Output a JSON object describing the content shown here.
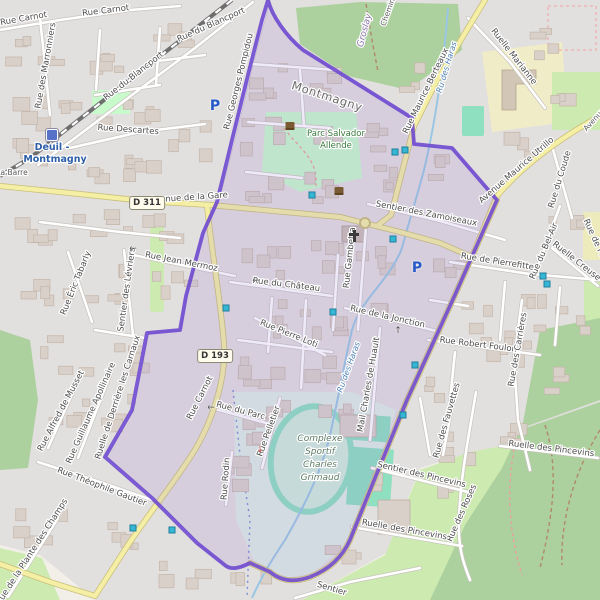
{
  "map": {
    "type": "openstreetmap-extract",
    "highlighted_boundary_commune": "Deuil-la-Barre / Montmagny area",
    "road_badges": [
      {
        "text": "D 311",
        "x": 147,
        "y": 203
      },
      {
        "text": "D 193",
        "x": 215,
        "y": 356
      }
    ],
    "labels": [
      {
        "t": "Rue Carnot",
        "x": 24,
        "y": 21,
        "r": -10,
        "c": "st"
      },
      {
        "t": "Rue Carnot",
        "x": 106,
        "y": 13,
        "r": -7,
        "c": "st"
      },
      {
        "t": "Rue du Blancport",
        "x": 212,
        "y": 27,
        "r": -24,
        "c": "st"
      },
      {
        "t": "Rue du Blancport",
        "x": 135,
        "y": 78,
        "r": -38,
        "c": "st"
      },
      {
        "t": "Rue des Marronniers",
        "x": 48,
        "y": 66,
        "r": -80,
        "c": "st"
      },
      {
        "t": "Rue Descartes",
        "x": 128,
        "y": 132,
        "r": 4,
        "c": "st"
      },
      {
        "t": "Rue Georges Pompidou",
        "x": 241,
        "y": 82,
        "r": -76,
        "c": "st"
      },
      {
        "t": "Ruelle Marianne",
        "x": 512,
        "y": 58,
        "r": 52,
        "c": "st"
      },
      {
        "t": "Rue Maurice Berteaux",
        "x": 428,
        "y": 92,
        "r": -64,
        "c": "st"
      },
      {
        "t": "Avenue Maurice Utrillo",
        "x": 518,
        "y": 172,
        "r": -41,
        "c": "st"
      },
      {
        "t": "Rue du Coude",
        "x": 562,
        "y": 180,
        "r": -73,
        "c": "st"
      },
      {
        "t": "Rue du Bel-Air",
        "x": 546,
        "y": 252,
        "r": -67,
        "c": "st"
      },
      {
        "t": "Ruelle Creuse",
        "x": 575,
        "y": 263,
        "r": 38,
        "c": "st"
      },
      {
        "t": "Rue de Pierrefitte",
        "x": 497,
        "y": 264,
        "r": 9,
        "c": "st"
      },
      {
        "t": "Rue de Pierrefitte",
        "x": 599,
        "y": 254,
        "r": 65,
        "c": "st"
      },
      {
        "t": "Rue Robert Foulon",
        "x": 478,
        "y": 347,
        "r": 7,
        "c": "st"
      },
      {
        "t": "Rue des Carrières",
        "x": 520,
        "y": 350,
        "r": -80,
        "c": "st"
      },
      {
        "t": "Sentier des Zamoiseaux",
        "x": 426,
        "y": 216,
        "r": 11,
        "c": "st"
      },
      {
        "t": "Rue Gambetta",
        "x": 352,
        "y": 258,
        "r": -84,
        "c": "st"
      },
      {
        "t": "Rue de la Jonction",
        "x": 387,
        "y": 319,
        "r": 13,
        "c": "st"
      },
      {
        "t": "Rue du Château",
        "x": 286,
        "y": 287,
        "r": 7,
        "c": "st"
      },
      {
        "t": "Rue Pierre Loti",
        "x": 288,
        "y": 336,
        "r": 22,
        "c": "st"
      },
      {
        "t": "Rue Jean Mermoz",
        "x": 181,
        "y": 264,
        "r": 11,
        "c": "st"
      },
      {
        "t": "Sentier des Lévriers",
        "x": 129,
        "y": 290,
        "r": -82,
        "c": "st"
      },
      {
        "t": "Rue Éric Tabarly",
        "x": 78,
        "y": 284,
        "r": -68,
        "c": "st"
      },
      {
        "t": "Rue Carnot",
        "x": 202,
        "y": 399,
        "r": -63,
        "c": "st"
      },
      {
        "t": "Rue du Parc",
        "x": 240,
        "y": 413,
        "r": 15,
        "c": "st"
      },
      {
        "t": "Rue Pelletier",
        "x": 271,
        "y": 432,
        "r": -70,
        "c": "st"
      },
      {
        "t": "Rue Rodin",
        "x": 228,
        "y": 479,
        "r": -86,
        "c": "st"
      },
      {
        "t": "Mail Charles de Huault",
        "x": 371,
        "y": 385,
        "r": -80,
        "c": "st"
      },
      {
        "t": "Rue des Fauvettes",
        "x": 449,
        "y": 421,
        "r": -74,
        "c": "st"
      },
      {
        "t": "Rue des Roses",
        "x": 464,
        "y": 514,
        "r": -66,
        "c": "st"
      },
      {
        "t": "Sentier des Pincevins",
        "x": 421,
        "y": 477,
        "r": 13,
        "c": "st"
      },
      {
        "t": "Ruelle des Pincevins",
        "x": 551,
        "y": 451,
        "r": 7,
        "c": "st"
      },
      {
        "t": "Ruelle des Pincevins",
        "x": 404,
        "y": 532,
        "r": 10,
        "c": "st"
      },
      {
        "t": "Rue Alfred de Musset",
        "x": 63,
        "y": 412,
        "r": -62,
        "c": "st"
      },
      {
        "t": "Rue Guillaume Apollinaire",
        "x": 93,
        "y": 414,
        "r": -66,
        "c": "st"
      },
      {
        "t": "Ruelle de Derrière les Carnaux",
        "x": 120,
        "y": 398,
        "r": -72,
        "c": "st"
      },
      {
        "t": "Rue Théophile Gautier",
        "x": 101,
        "y": 489,
        "r": 21,
        "c": "st"
      },
      {
        "t": "Rue de la Plante des Champs",
        "x": 34,
        "y": 553,
        "r": -57,
        "c": "st"
      },
      {
        "t": "Avenue de la Gare",
        "x": 189,
        "y": 200,
        "r": -4,
        "c": "st"
      },
      {
        "t": "Sentier",
        "x": 331,
        "y": 591,
        "r": 17,
        "c": "st"
      },
      {
        "t": "La Barre",
        "x": 12,
        "y": 175,
        "r": 0,
        "c": "stsm"
      },
      {
        "t": "Groslay",
        "x": 367,
        "y": 31,
        "r": -75,
        "c": "bname"
      },
      {
        "t": "Chemin",
        "x": 390,
        "y": 13,
        "r": -70,
        "c": "stsm"
      },
      {
        "t": "Avenue",
        "x": 596,
        "y": 121,
        "r": -48,
        "c": "stsm"
      },
      {
        "t": "Montmagny",
        "x": 326,
        "y": 100,
        "r": 18,
        "c": "city"
      },
      {
        "t": "Parc Salvador",
        "x": 336,
        "y": 136,
        "r": 0,
        "c": "park"
      },
      {
        "t": "Allende",
        "x": 336,
        "y": 148,
        "r": 0,
        "c": "park"
      },
      {
        "t": "Complexe",
        "x": 320,
        "y": 441,
        "r": 0,
        "c": "sport"
      },
      {
        "t": "Sportif",
        "x": 320,
        "y": 454,
        "r": 0,
        "c": "sport"
      },
      {
        "t": "Charles",
        "x": 320,
        "y": 467,
        "r": 0,
        "c": "sport"
      },
      {
        "t": "Grimaud",
        "x": 320,
        "y": 480,
        "r": 0,
        "c": "sport"
      },
      {
        "t": "Ru des Haras",
        "x": 449,
        "y": 68,
        "r": -73,
        "c": "water"
      },
      {
        "t": "Ru des Haras",
        "x": 351,
        "y": 368,
        "r": -70,
        "c": "water"
      },
      {
        "t": "Deuil -",
        "x": 52,
        "y": 150,
        "r": 0,
        "c": "station"
      },
      {
        "t": "Montmagny",
        "x": 55,
        "y": 162,
        "r": 0,
        "c": "station"
      }
    ],
    "icons": {
      "parking": [
        {
          "x": 215,
          "y": 106
        },
        {
          "x": 417,
          "y": 268
        }
      ],
      "station": {
        "x": 52,
        "y": 135,
        "name": "Deuil - Montmagny"
      },
      "church": {
        "x": 354,
        "y": 236
      },
      "town_hall": {
        "x": 339,
        "y": 191
      },
      "landmark": {
        "x": 290,
        "y": 126
      },
      "stop_markers": [
        [
          312,
          195
        ],
        [
          395,
          152
        ],
        [
          405,
          150
        ],
        [
          226,
          308
        ],
        [
          333,
          312
        ],
        [
          393,
          239
        ],
        [
          415,
          365
        ],
        [
          403,
          415
        ],
        [
          543,
          276
        ],
        [
          547,
          284
        ],
        [
          133,
          528
        ],
        [
          172,
          530
        ]
      ],
      "arrows": [
        {
          "x": 133,
          "y": 249,
          "glyph": "←",
          "color": "#555555"
        },
        {
          "x": 256,
          "y": 281,
          "glyph": "←",
          "color": "#555555"
        },
        {
          "x": 211,
          "y": 408,
          "glyph": "←",
          "color": "#555555"
        },
        {
          "x": 398,
          "y": 331,
          "glyph": "↑",
          "color": "#555555"
        },
        {
          "x": 260,
          "y": 450,
          "glyph": "↓",
          "color": "#c04040"
        }
      ]
    },
    "colors": {
      "background": "#f2efe9",
      "residential": "#e2dfdf",
      "boundary_purple": "#6b46cf",
      "boundary_tint": "rgba(150,115,215,0.15)",
      "road_yellow": "#f4efa5",
      "road_yellow_casing": "#c9bf7a",
      "road_white": "#ffffff",
      "road_casing": "#c8c4be",
      "water": "#99c7e3",
      "forest": "#add19e",
      "grass": "#cdebb0",
      "park": "#c8facc",
      "pitch": "#8ee0c0",
      "school": "#f1ecc8",
      "building": "#d9d0c9",
      "railway": "#6e6e6e"
    }
  }
}
